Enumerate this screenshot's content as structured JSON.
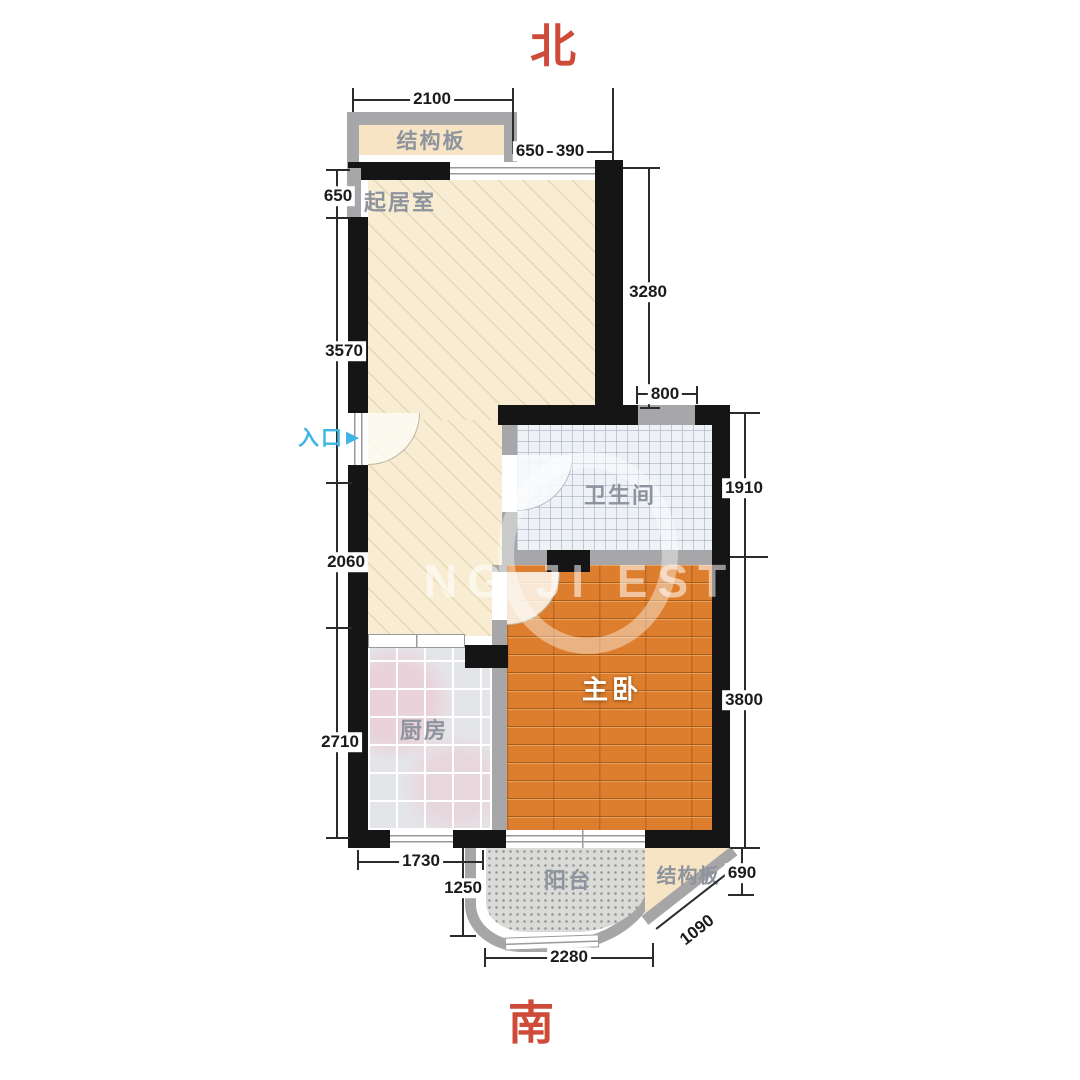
{
  "compass": {
    "north": "北",
    "south": "南"
  },
  "entrance": {
    "label": "入口",
    "arrow": "▶"
  },
  "rooms": {
    "structural_top": "结构板",
    "living": "起居室",
    "bathroom": "卫生间",
    "bedroom": "主卧",
    "kitchen": "厨房",
    "balcony": "阳台",
    "structural_bottom": "结构板"
  },
  "dims": {
    "t2100": "2100",
    "tr650": "650",
    "tr390": "390",
    "l650": "650",
    "l3570": "3570",
    "l2060": "2060",
    "l2710": "2710",
    "r3280": "3280",
    "b800": "800",
    "r1910": "1910",
    "r3800": "3800",
    "r690": "690",
    "d1090": "1090",
    "b1730": "1730",
    "b1250": "1250",
    "b2280": "2280"
  },
  "watermark": {
    "text": "NG JI ESTA"
  },
  "colors": {
    "compass_red": "#cf4b39",
    "entrance_cyan": "#3fb5e6",
    "wall_black": "#151515",
    "wall_gray": "#a7a7a9",
    "living_cream": "#f8edd3",
    "bedroom_wood": "#dd7e2e",
    "kitchen_tile": "#e4e5e8",
    "bathroom_tile": "#eef1f5",
    "structural_tan": "#f6e4c5"
  }
}
